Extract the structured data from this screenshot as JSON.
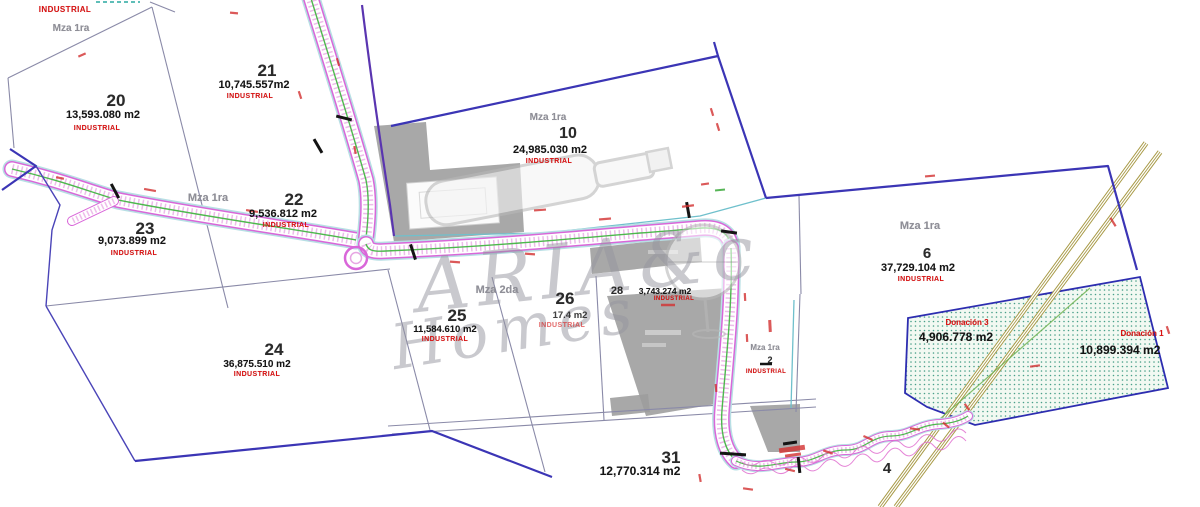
{
  "map": {
    "labels": {
      "top_industrial": "INDUSTRIAL",
      "block_top_left": "Mza 1ra",
      "block_mid_left": "Mza 1ra",
      "block_mid_center": "Mza 2da"
    },
    "parcels": [
      {
        "id": "20",
        "area": "13,593.080 m2",
        "zoning": "INDUSTRIAL"
      },
      {
        "id": "21",
        "area": "10,745.557m2",
        "zoning": "INDUSTRIAL"
      },
      {
        "id": "22",
        "area": "9,536.812 m2",
        "zoning": "INDUSTRIAL"
      },
      {
        "id": "23",
        "area": "9,073.899 m2",
        "zoning": "INDUSTRIAL"
      },
      {
        "id": "24",
        "area": "36,875.510 m2",
        "zoning": "INDUSTRIAL"
      },
      {
        "id": "25",
        "area": "11,584.610 m2",
        "zoning": "INDUSTRIAL"
      },
      {
        "id": "26",
        "area": "17.4 m2",
        "zoning": "INDUSTRIAL"
      },
      {
        "id": "28",
        "area": "3,743.274 m2",
        "zoning": "INDUSTRIAL"
      },
      {
        "id": "10",
        "block": "Mza 1ra",
        "area": "24,985.030 m2",
        "zoning": "INDUSTRIAL"
      },
      {
        "id": "6",
        "block": "Mza 1ra",
        "area": "37,729.104 m2",
        "zoning": "INDUSTRIAL"
      },
      {
        "id": "2",
        "block": "Mza 1ra",
        "zoning": "INDUSTRIAL"
      },
      {
        "id": "31",
        "area": "12,770.314 m2"
      },
      {
        "id": "4"
      }
    ],
    "donations": [
      {
        "label": "Donación 3",
        "area": "4,906.778 m2"
      },
      {
        "label": "Donación 1",
        "area": "10,899.394 m2"
      }
    ],
    "watermark": {
      "line1": "ARIA&c",
      "line2": "Homes"
    },
    "colors": {
      "boundary_blue": "#3b35b5",
      "parcel_line": "#8a8aa8",
      "road_edge_magenta": "#d966d9",
      "road_center_green": "#4db84d",
      "road_outer_cyan": "#b7dfe4",
      "zoning_red": "#dd1111",
      "donation_dot_teal": "#49a08a",
      "rail_olive": "#a89a46"
    }
  }
}
